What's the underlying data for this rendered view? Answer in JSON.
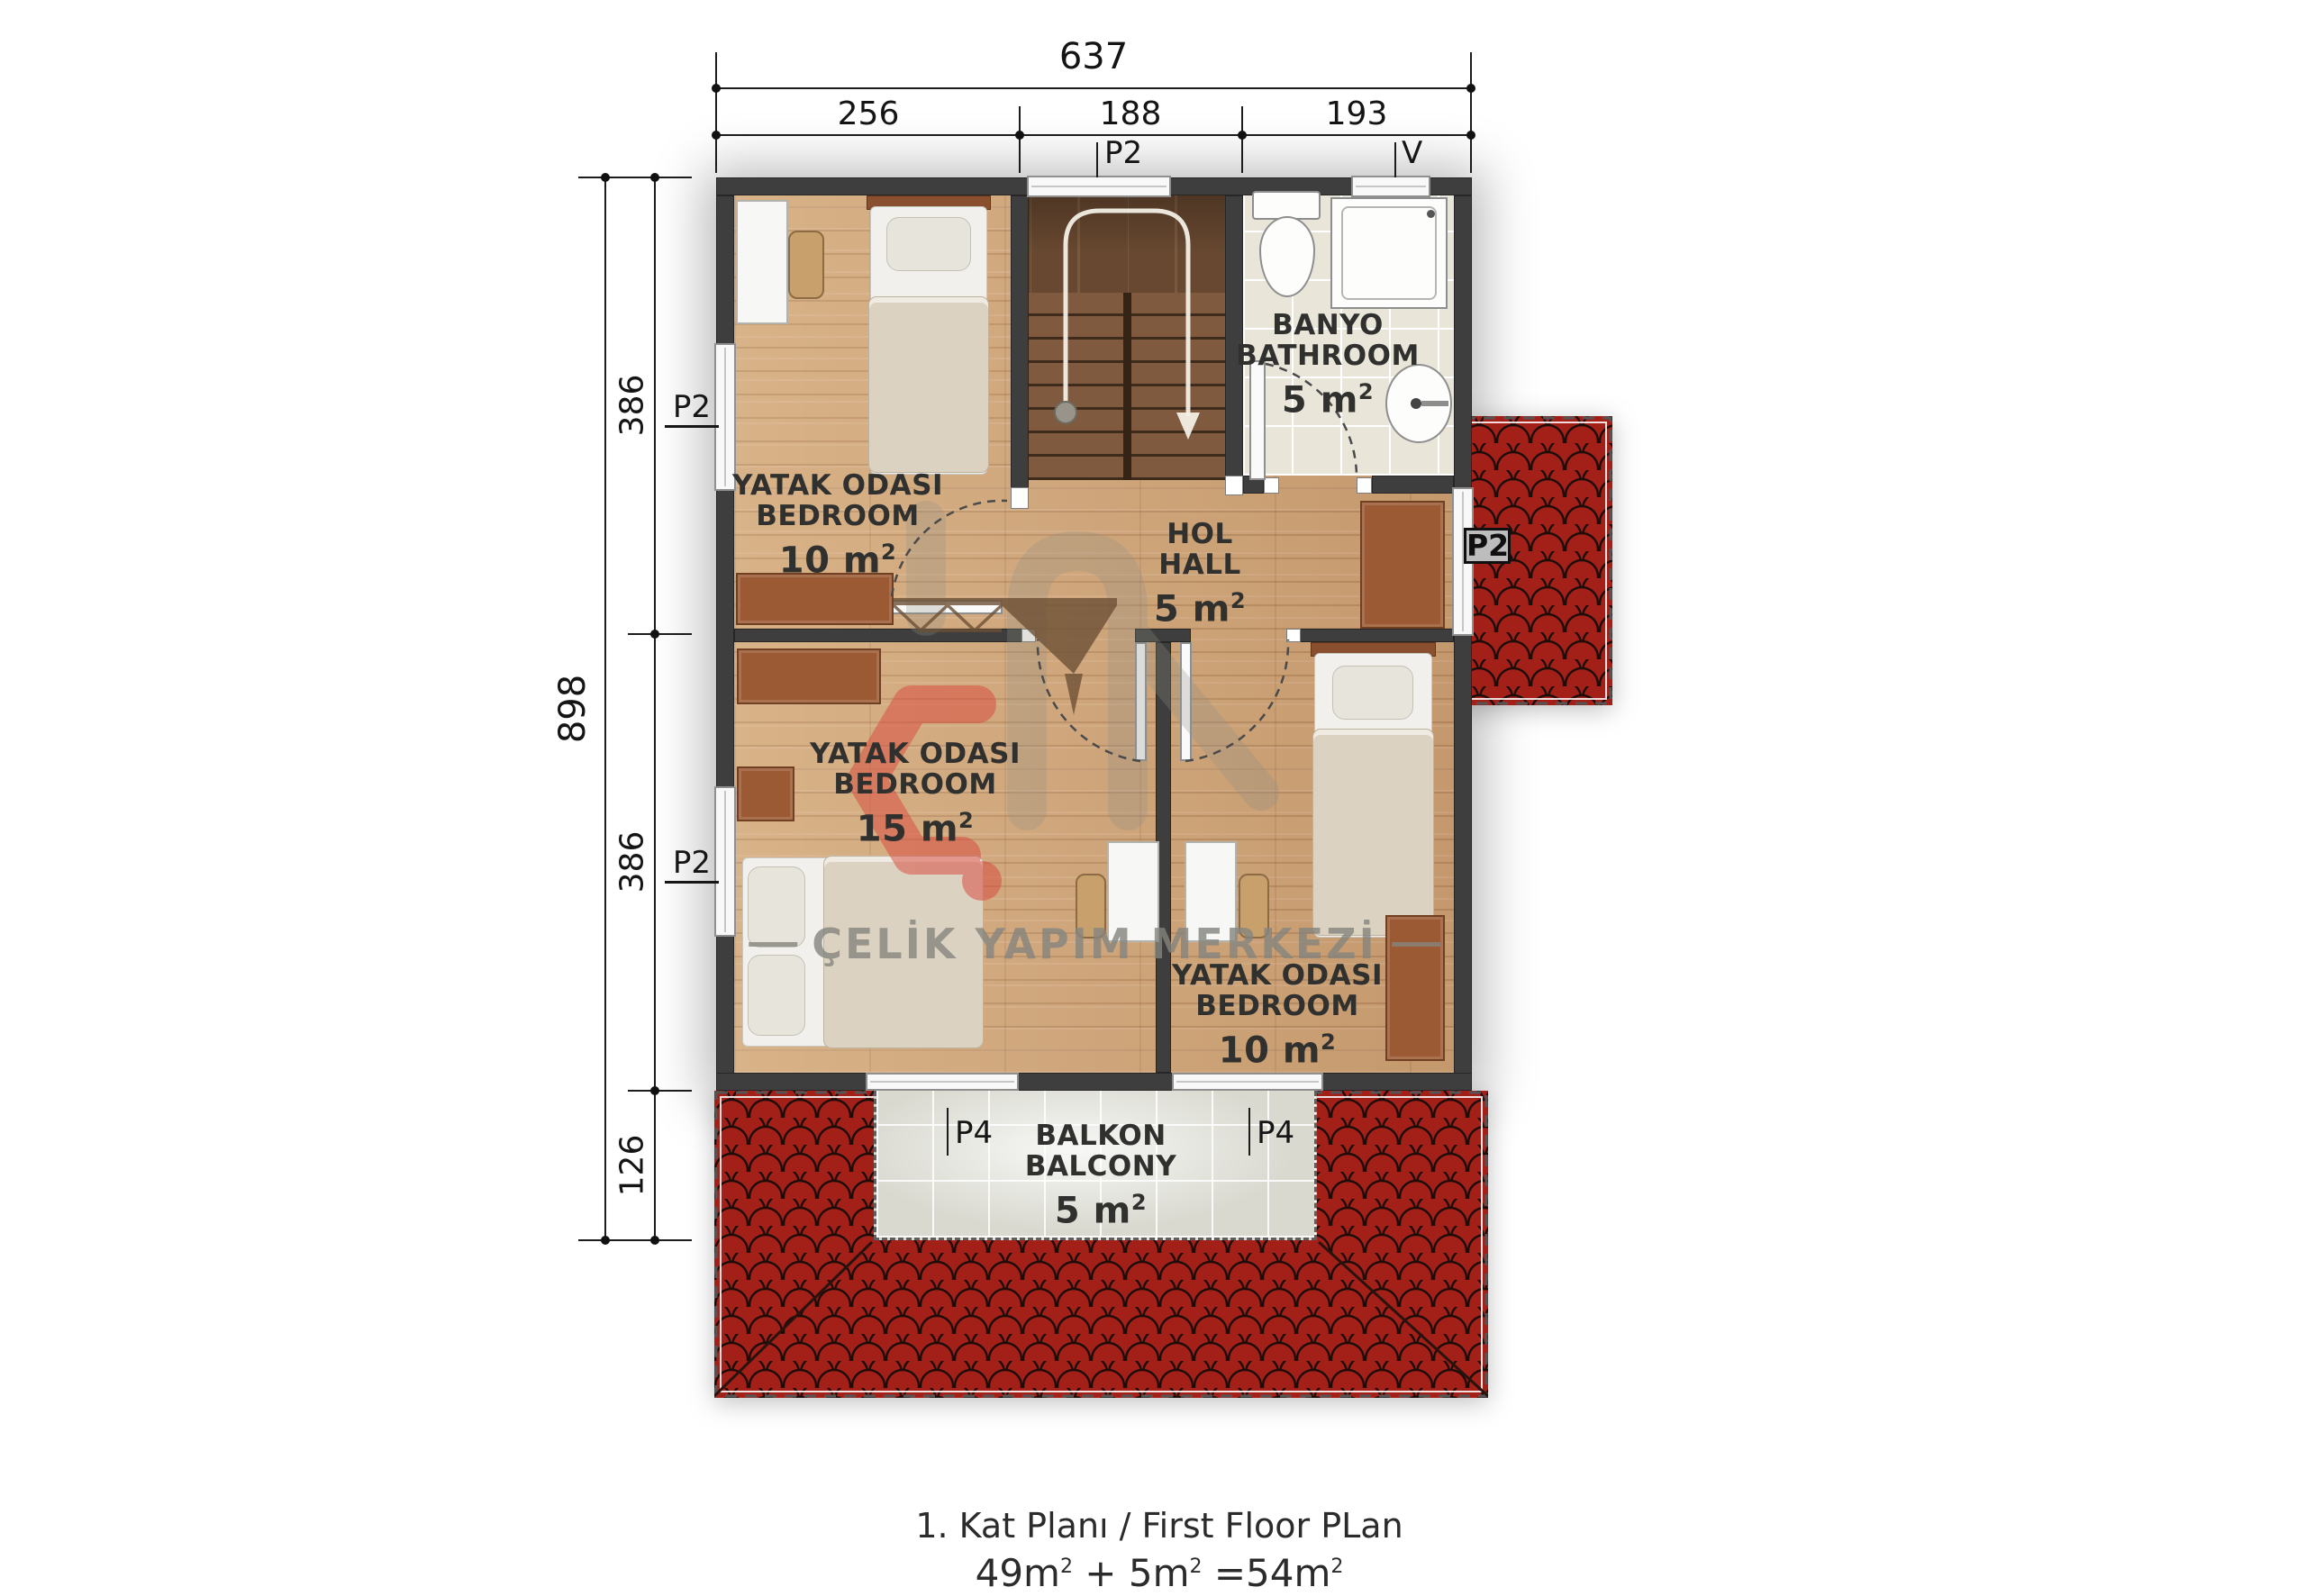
{
  "dimensions": {
    "top": {
      "total": "637",
      "seg1": "256",
      "seg2": "188",
      "seg3": "193"
    },
    "left": {
      "total": "898",
      "seg1": "386",
      "seg2": "386",
      "seg3": "126"
    }
  },
  "labels": {
    "p2": "P2",
    "p4": "P4",
    "v": "V"
  },
  "rooms": {
    "bedroom_tl": {
      "name_tr": "YATAK ODASI",
      "name_en": "BEDROOM",
      "area": "10 m",
      "sup": "2"
    },
    "bedroom_mid": {
      "name_tr": "YATAK ODASI",
      "name_en": "BEDROOM",
      "area": "15 m",
      "sup": "2"
    },
    "bedroom_r": {
      "name_tr": "YATAK ODASI",
      "name_en": "BEDROOM",
      "area": "10 m",
      "sup": "2"
    },
    "bathroom": {
      "name_tr": "BANYO",
      "name_en": "BATHROOM",
      "area": "5 m",
      "sup": "2"
    },
    "hall": {
      "name_tr": "HOL",
      "name_en": "HALL",
      "area": "5 m",
      "sup": "2"
    },
    "balcony": {
      "name_tr": "BALKON",
      "name_en": "BALCONY",
      "area": "5 m",
      "sup": "2"
    }
  },
  "watermark": {
    "text": "ÇELİK YAPIM MERKEZİ"
  },
  "footer": {
    "line1": "1. Kat Planı / First Floor PLan",
    "eq": [
      "49m",
      "2",
      " + 5m",
      "2",
      " =54m",
      "2"
    ]
  },
  "colors": {
    "roof": "#a2211a",
    "wall": "#3e3e3e",
    "wood": "#cfa478",
    "logo_red": "#d8453a"
  }
}
